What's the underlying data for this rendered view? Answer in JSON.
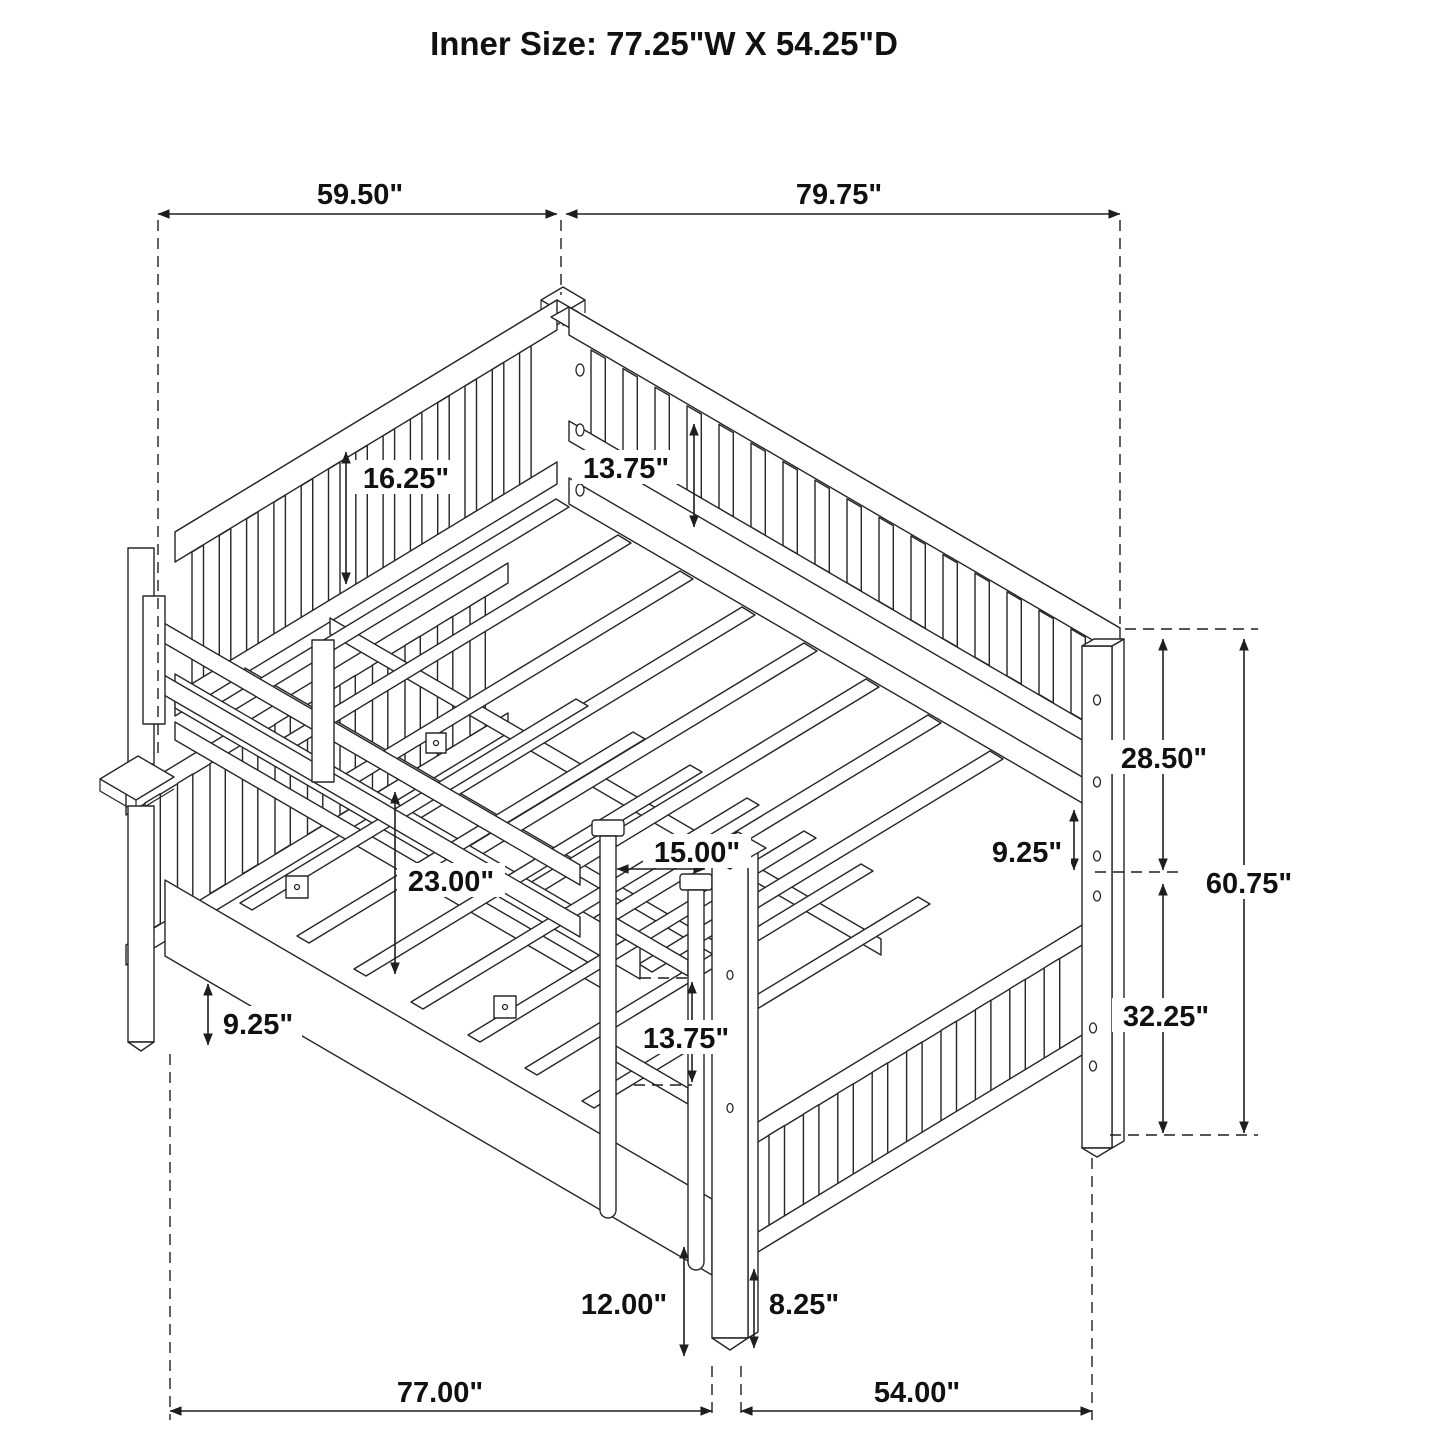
{
  "title": "Inner Size: 77.25\"W X 54.25\"D",
  "dims": {
    "top_width_left": "59.50\"",
    "top_width_right": "79.75\"",
    "headboard_panel_height": "16.25\"",
    "upper_rail_assembly_height": "13.75\"",
    "upper_section_height": "28.50\"",
    "right_rail_gap": "9.25\"",
    "overall_height": "60.75\"",
    "lower_section_height": "32.25\"",
    "under_upper_bunk_clearance": "23.00\"",
    "ladder_opening_width": "15.00\"",
    "lower_rail_assembly_height": "13.75\"",
    "under_bed_clearance": "9.25\"",
    "ladder_bottom_height": "12.00\"",
    "post_leg_height": "8.25\"",
    "base_width": "77.00\"",
    "base_depth": "54.00\""
  },
  "colors": {
    "line": "#1e1e1e",
    "background": "#ffffff"
  }
}
